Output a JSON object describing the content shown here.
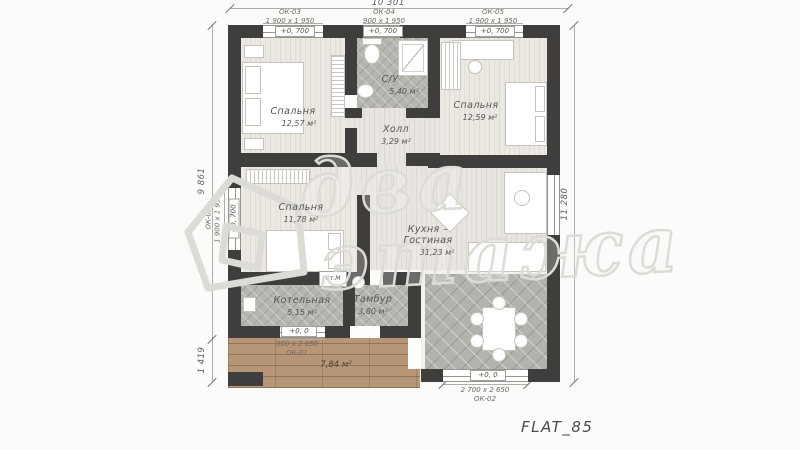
{
  "plan_code": "FLAT_85",
  "watermark": {
    "line1": "два",
    "line2": "этажа"
  },
  "dimensions": {
    "top": "10 301",
    "left_main": "9 861",
    "left_terrace": "1 419",
    "right": "11 280"
  },
  "rooms": {
    "bedroom1": {
      "name": "Спальня",
      "area": "12,57 м²"
    },
    "bathroom": {
      "name": "С/У",
      "area": "5,40 м²"
    },
    "bedroom2": {
      "name": "Спальня",
      "area": "12,59 м²"
    },
    "hall": {
      "name": "Холл",
      "area": "3,29 м²"
    },
    "bedroom3": {
      "name": "Спальня",
      "area": "11,78 м²"
    },
    "kitchen_living": {
      "name_line1": "Кухня –",
      "name_line2": "Гостиная",
      "area": "31,23 м²"
    },
    "boiler": {
      "name": "Котельная",
      "area": "5,15 м²"
    },
    "vestibule": {
      "name": "Тамбур",
      "area": "3,80 м²"
    },
    "terrace": {
      "area": "7,84 м²"
    }
  },
  "windows": {
    "ok03_top": {
      "code": "ОК-03",
      "size": "1 900 х 1 950",
      "elevation": "+0, 700"
    },
    "ok04_top": {
      "code": "ОК-04",
      "size": "900 х 1 950",
      "elevation": "+0, 700"
    },
    "ok05_top": {
      "code": "ОК-05",
      "size": "1 900 х 1 950",
      "elevation": "+0, 700"
    },
    "ok03_left": {
      "code": "ОК-03",
      "size": "1 900 х 1 950",
      "elevation": "+0, 700"
    },
    "ok01_bottom": {
      "code": "ОК-01",
      "size": "900 х 2 650",
      "elevation": "+0, 0"
    },
    "ok02_bottom": {
      "code": "ОК-02",
      "size": "2 700 х 2 650",
      "elevation": "+0, 0"
    }
  },
  "annotations": {
    "washer": "Ст.М"
  },
  "colors": {
    "wall": "#3f3e3c",
    "deck_wood": "#b69677",
    "tile": "#b6b5af",
    "floor_wood": "#ebe7e1"
  }
}
